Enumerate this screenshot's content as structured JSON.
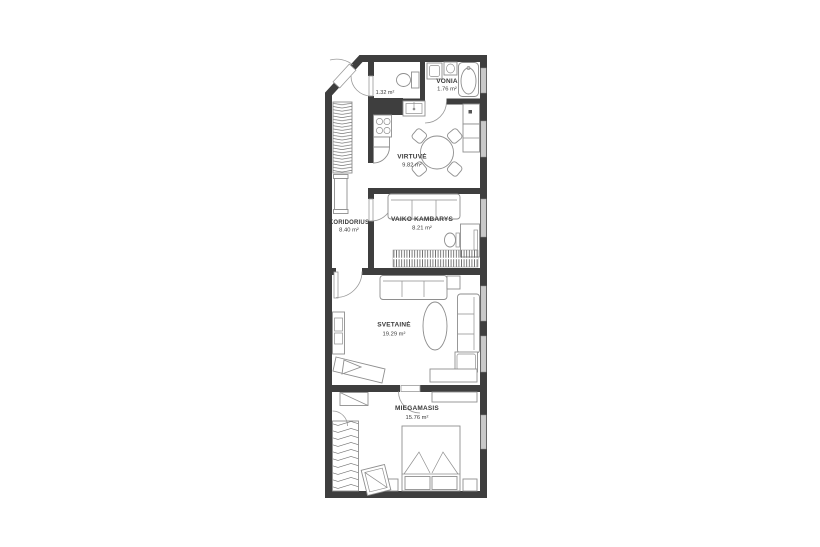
{
  "floorplan": {
    "colors": {
      "wall": "#3e3e3e",
      "furniture": "#8e8e8e",
      "window": "#c9c9c9",
      "text": "#3a3a3a"
    },
    "rooms": {
      "wc": {
        "area": "1.32 m²"
      },
      "vonia": {
        "name": "VONIA",
        "area": "1.76 m²"
      },
      "virtuve": {
        "name": "VIRTUVĖ",
        "area": "9.82 m²"
      },
      "koridorius": {
        "name": "KORIDORIUS",
        "area": "8.40 m²"
      },
      "vaiko_kambarys": {
        "name": "VAIKO KAMBARYS",
        "area": "8.21 m²"
      },
      "svetaine": {
        "name": "SVETAINĖ",
        "area": "19.29 m²"
      },
      "miegamasis": {
        "name": "MIEGAMASIS",
        "area": "15.76 m²"
      }
    }
  }
}
